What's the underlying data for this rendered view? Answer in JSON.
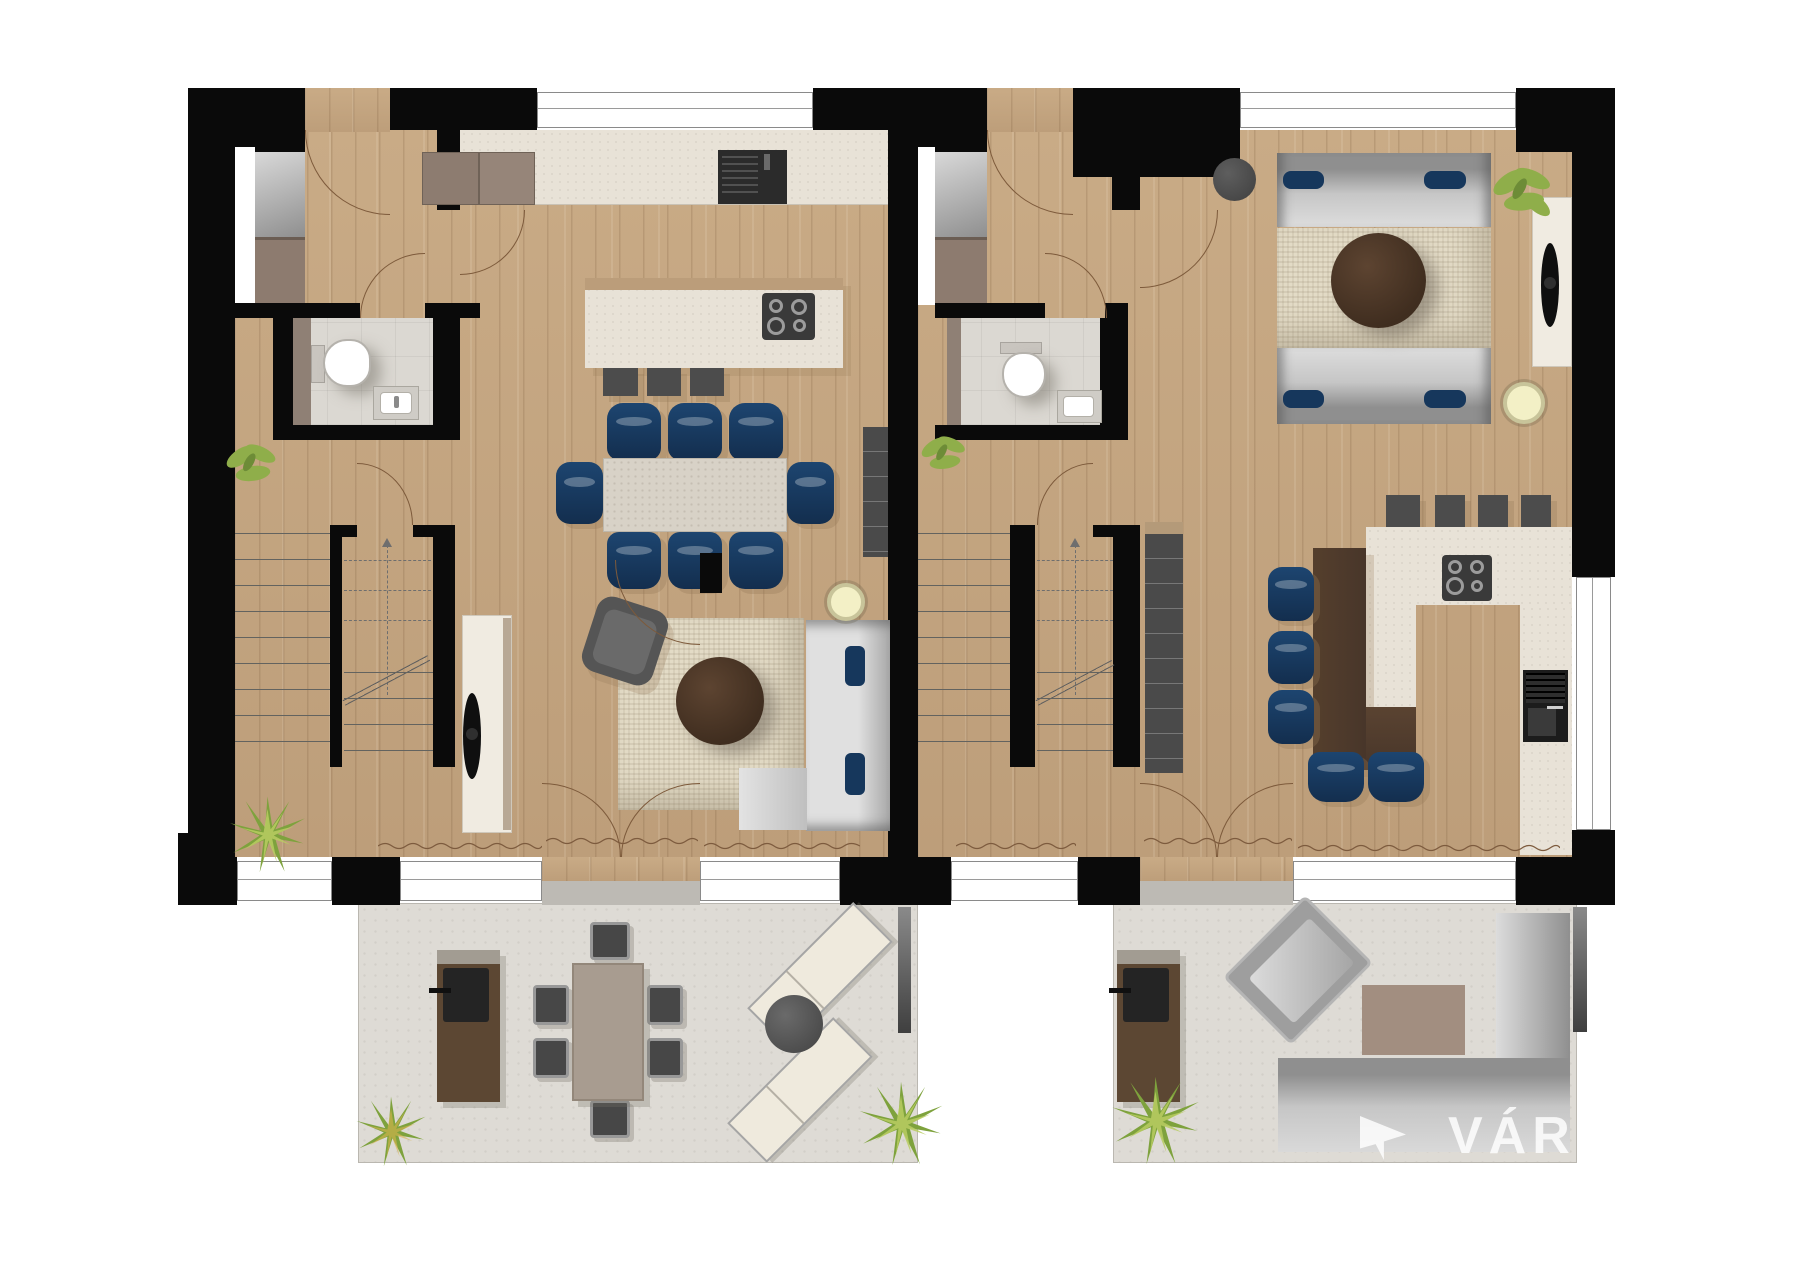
{
  "watermark": {
    "text": "VÁR",
    "logo": "arrow-flag-icon"
  },
  "palette": {
    "wall": "#0a0a0a",
    "wood_floor": "#c6a883",
    "tile_floor": "#dbd8d2",
    "terrace": "#dedbd5",
    "counter": "#e8e2d7",
    "navy_chair": "#16375c",
    "sofa_gray": "#c6c6c6",
    "stone_table": "#d8d2c7",
    "dark_wood": "#4a3628",
    "plant_green": "#7ea23d",
    "appliance_dark": "#2e2e2e",
    "accent_brown": "#8d7b6f"
  },
  "plan": {
    "type": "residential-floor-plan",
    "units": [
      {
        "id": "unit-a",
        "side": "left",
        "rooms": [
          "entry-hall",
          "wc",
          "kitchen",
          "dining-area",
          "living-area",
          "staircase"
        ],
        "furniture": [
          "wardrobe-with-mirror",
          "toilet",
          "washbasin",
          "kitchen-counter",
          "kitchen-sink",
          "tall-cabinets",
          "kitchen-island",
          "induction-hob",
          "bar-stools-3",
          "dining-table",
          "dining-chairs-8",
          "area-rug",
          "round-coffee-table",
          "armchair",
          "sofa-with-chaise",
          "cushions",
          "floor-lamp",
          "tv-sideboard",
          "wall-shelf",
          "plants"
        ]
      },
      {
        "id": "unit-b",
        "side": "right",
        "rooms": [
          "entry-hall",
          "wc",
          "living-area",
          "kitchen-dining",
          "staircase"
        ],
        "furniture": [
          "wardrobe-with-mirror",
          "toilet",
          "washbasin",
          "sofa-pair",
          "cushions",
          "area-rug",
          "round-coffee-table",
          "pouf",
          "tv-sideboard",
          "floor-lamp",
          "u-shaped-kitchen",
          "induction-hob",
          "built-in-oven",
          "bar-stools-4",
          "wood-dining-table",
          "dining-chairs-5",
          "wall-shelf",
          "plants"
        ]
      }
    ],
    "terraces": [
      {
        "id": "terrace-a",
        "side": "left",
        "furniture": [
          "bbq-grill-station",
          "outdoor-dining-table",
          "outdoor-chairs-6",
          "sun-loungers-2",
          "round-side-table",
          "plants"
        ]
      },
      {
        "id": "terrace-b",
        "side": "right",
        "furniture": [
          "bbq-grill-station",
          "lounge-armchair",
          "outdoor-rug",
          "corner-sofa",
          "plants"
        ]
      }
    ]
  }
}
